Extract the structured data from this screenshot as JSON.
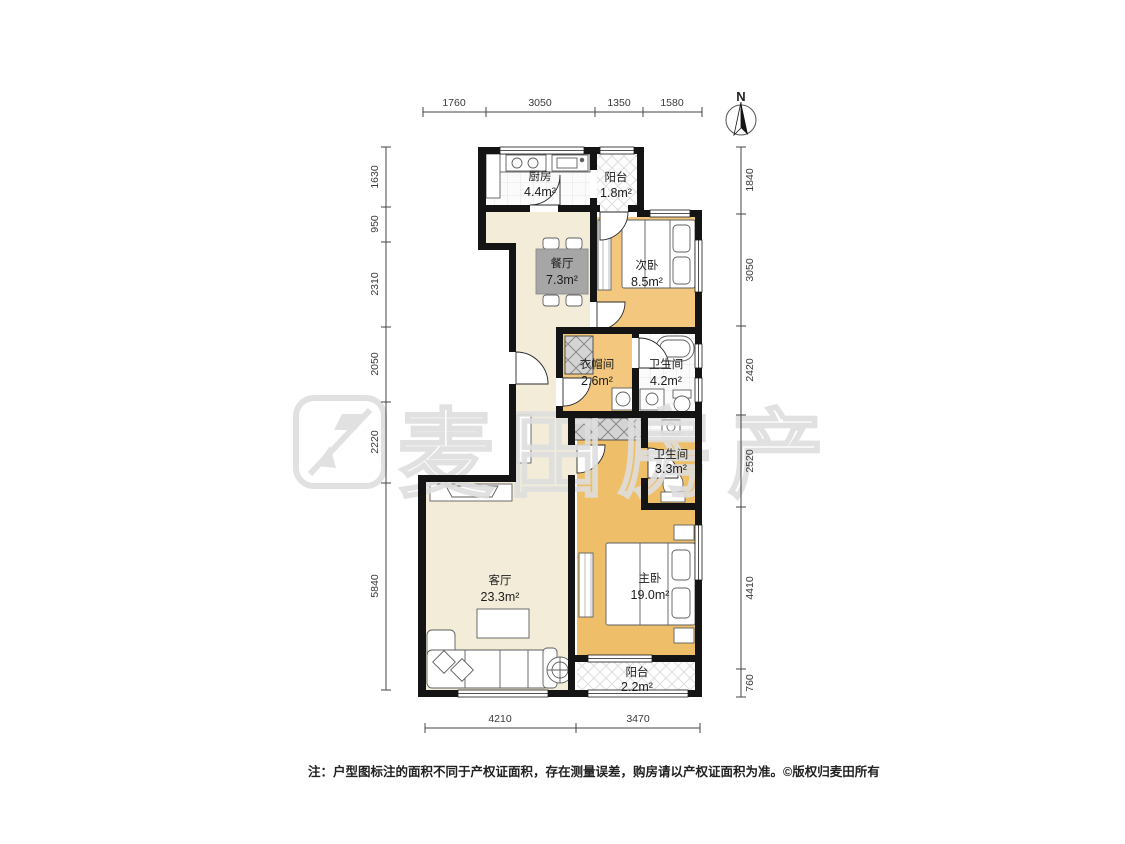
{
  "north_label": "N",
  "watermark": {
    "text": "麦田房产"
  },
  "rooms": [
    {
      "id": "kitchen",
      "name": "厨房",
      "area": "4.4m²"
    },
    {
      "id": "balcony-north",
      "name": "阳台",
      "area": "1.8m²"
    },
    {
      "id": "dining",
      "name": "餐厅",
      "area": "7.3m²"
    },
    {
      "id": "bedroom-second",
      "name": "次卧",
      "area": "8.5m²"
    },
    {
      "id": "cloakroom",
      "name": "衣帽间",
      "area": "2.6m²"
    },
    {
      "id": "bathroom-a",
      "name": "卫生间",
      "area": "4.2m²"
    },
    {
      "id": "bathroom-b",
      "name": "卫生间",
      "area": "3.3m²"
    },
    {
      "id": "living",
      "name": "客厅",
      "area": "23.3m²"
    },
    {
      "id": "bedroom-master",
      "name": "主卧",
      "area": "19.0m²"
    },
    {
      "id": "balcony-south",
      "name": "阳台",
      "area": "2.2m²"
    }
  ],
  "dimensions": {
    "top": [
      "1760",
      "3050",
      "1350",
      "1580"
    ],
    "left": [
      "1630",
      "950",
      "2310",
      "2050",
      "2220",
      "5840"
    ],
    "right": [
      "1840",
      "3050",
      "2420",
      "2520",
      "4410",
      "760"
    ],
    "bottom": [
      "4210",
      "3470"
    ]
  },
  "footer": {
    "note": "注：户型图标注的面积不同于产权证面积，存在测量误差，购房请以产权证面积为准。",
    "copyright": "©版权归麦田所有"
  },
  "colors": {
    "wall": "#141414",
    "floor_warm": "#f2ecd9",
    "floor_bedroom": "#f3c87e",
    "floor_master": "#eebf68",
    "watermark": "#dedede"
  }
}
